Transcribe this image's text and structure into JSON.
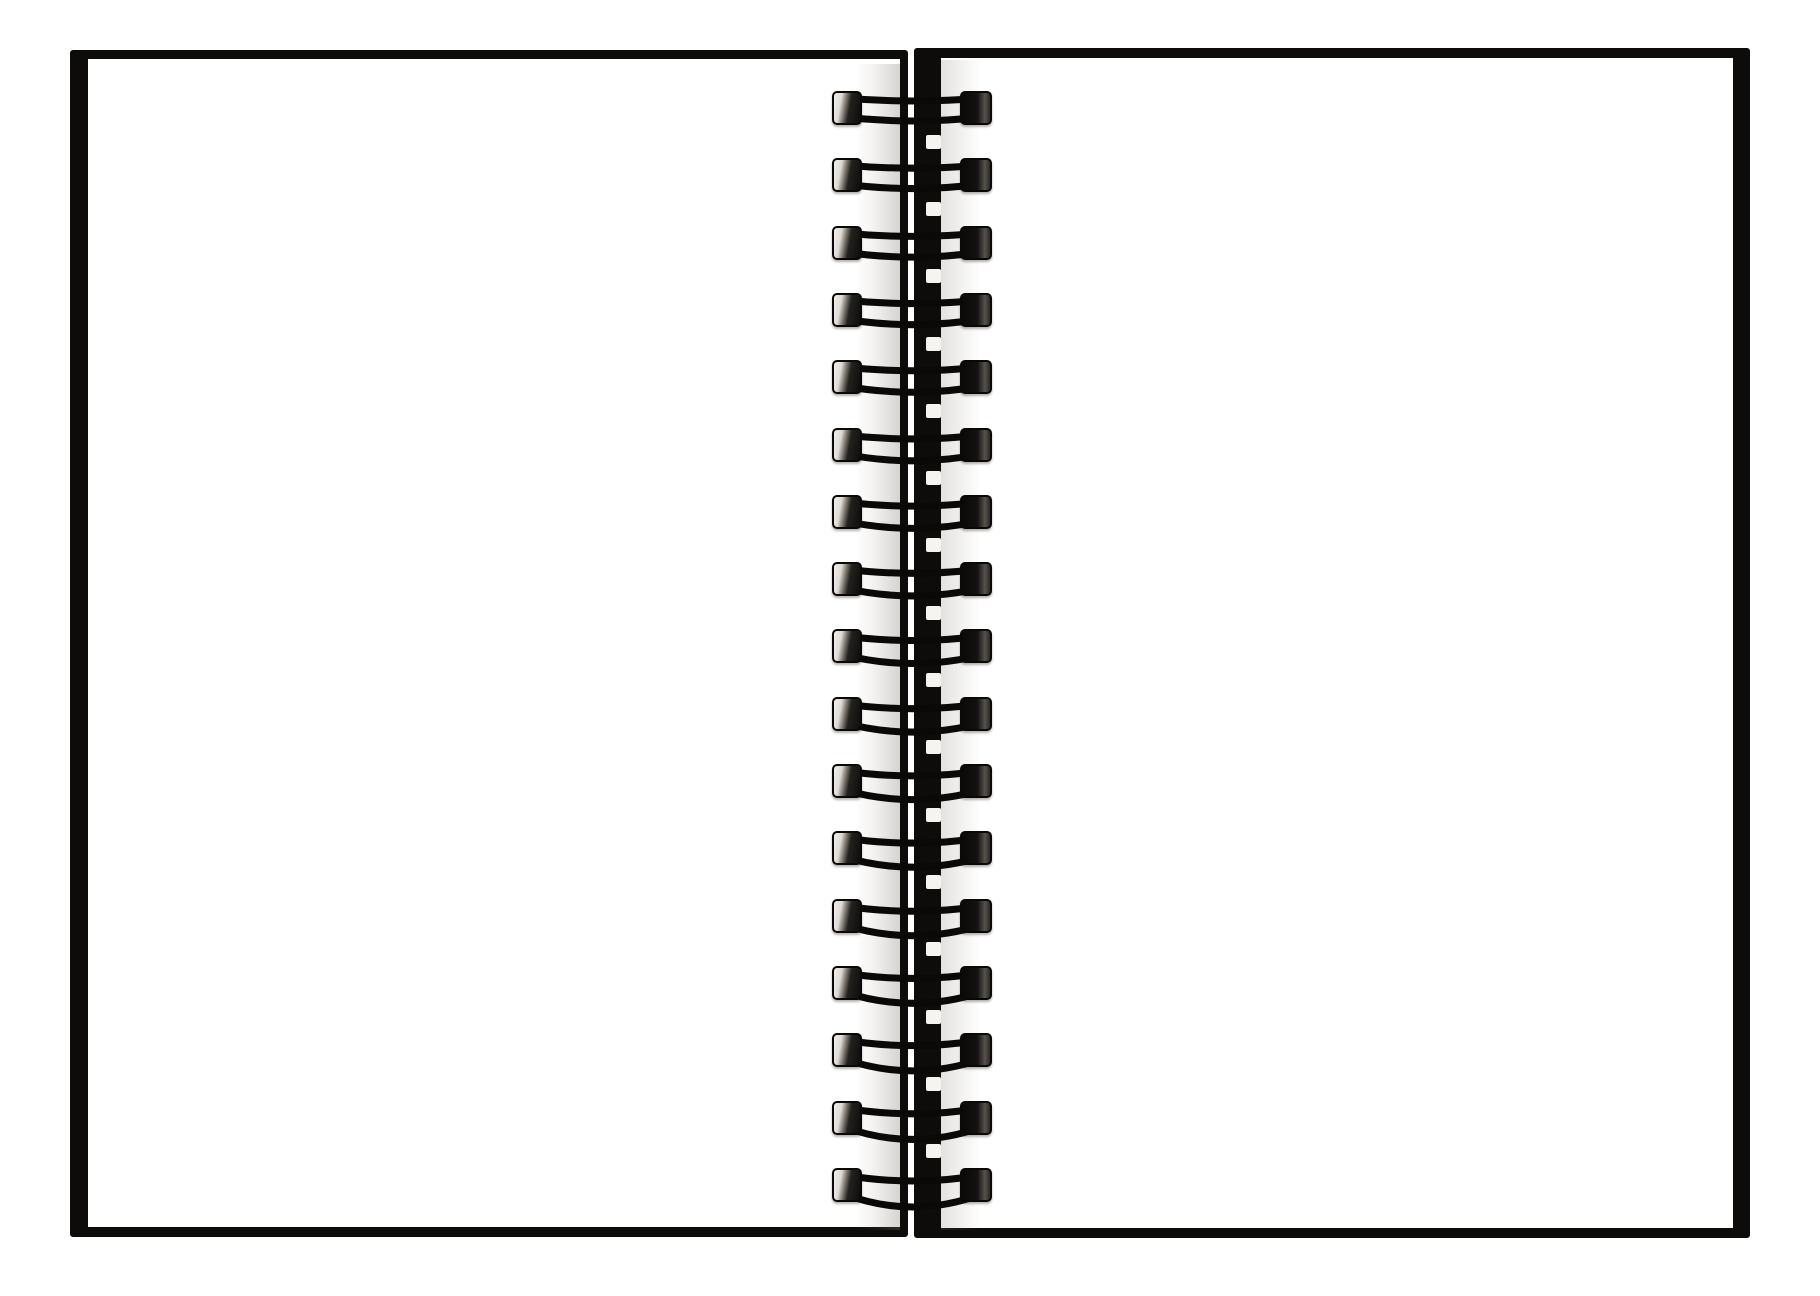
{
  "scene": {
    "description": "Open blank spiral-bound notebook photographed from above on a white background",
    "background_color": "#ffffff",
    "page_color": "#ffffff",
    "cover_color": "#0d0c0b",
    "wire_color": "#0a0908",
    "left_page_blank": true,
    "right_page_blank": true
  },
  "binding": {
    "type": "wire-o-double-loop",
    "loop_count": 17,
    "first_center_y": 108,
    "spacing": 67.3,
    "loop_layer_left": 830,
    "loop_width": 166,
    "loop_height": 80,
    "wire_stroke_width": 7,
    "top_wire_dip_min": 3,
    "top_wire_dip_max": 6,
    "bottom_wire_sag_min": 4,
    "bottom_wire_sag_max": 13,
    "notch_color": "#f6f4f0"
  }
}
